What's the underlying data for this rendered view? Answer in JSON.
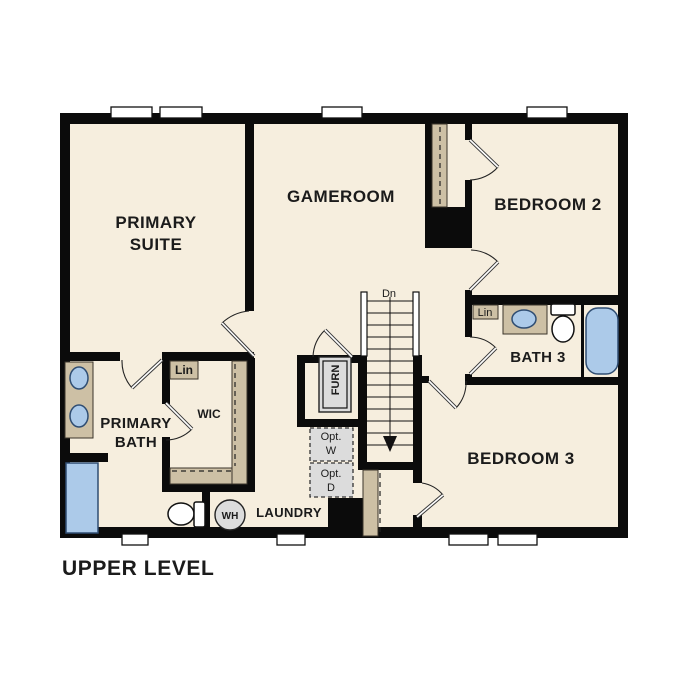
{
  "title": "UPPER LEVEL",
  "colors": {
    "wall": "#0b0b0b",
    "floor": "#f6eede",
    "shelf": "#cdc0a5",
    "fixture_blue": "#accae9",
    "equip_gray": "#dcdcdc",
    "text": "#1b1b1b"
  },
  "rooms": {
    "primary_suite": {
      "line1": "PRIMARY",
      "line2": "SUITE"
    },
    "gameroom": {
      "label": "GAMEROOM"
    },
    "bedroom2": {
      "label": "BEDROOM 2"
    },
    "bedroom3": {
      "label": "BEDROOM 3"
    },
    "bath3": {
      "label": "BATH 3"
    },
    "primary_bath": {
      "line1": "PRIMARY",
      "line2": "BATH"
    },
    "wic": {
      "label": "WIC"
    },
    "laundry": {
      "label": "LAUNDRY"
    }
  },
  "features": {
    "stairs_direction": "Dn",
    "furnace": "FURN",
    "water_heater": "WH",
    "linen_primary": "Lin",
    "linen_bath3": "Lin",
    "optional_washer": {
      "line1": "Opt.",
      "line2": "W"
    },
    "optional_dryer": {
      "line1": "Opt.",
      "line2": "D"
    }
  }
}
